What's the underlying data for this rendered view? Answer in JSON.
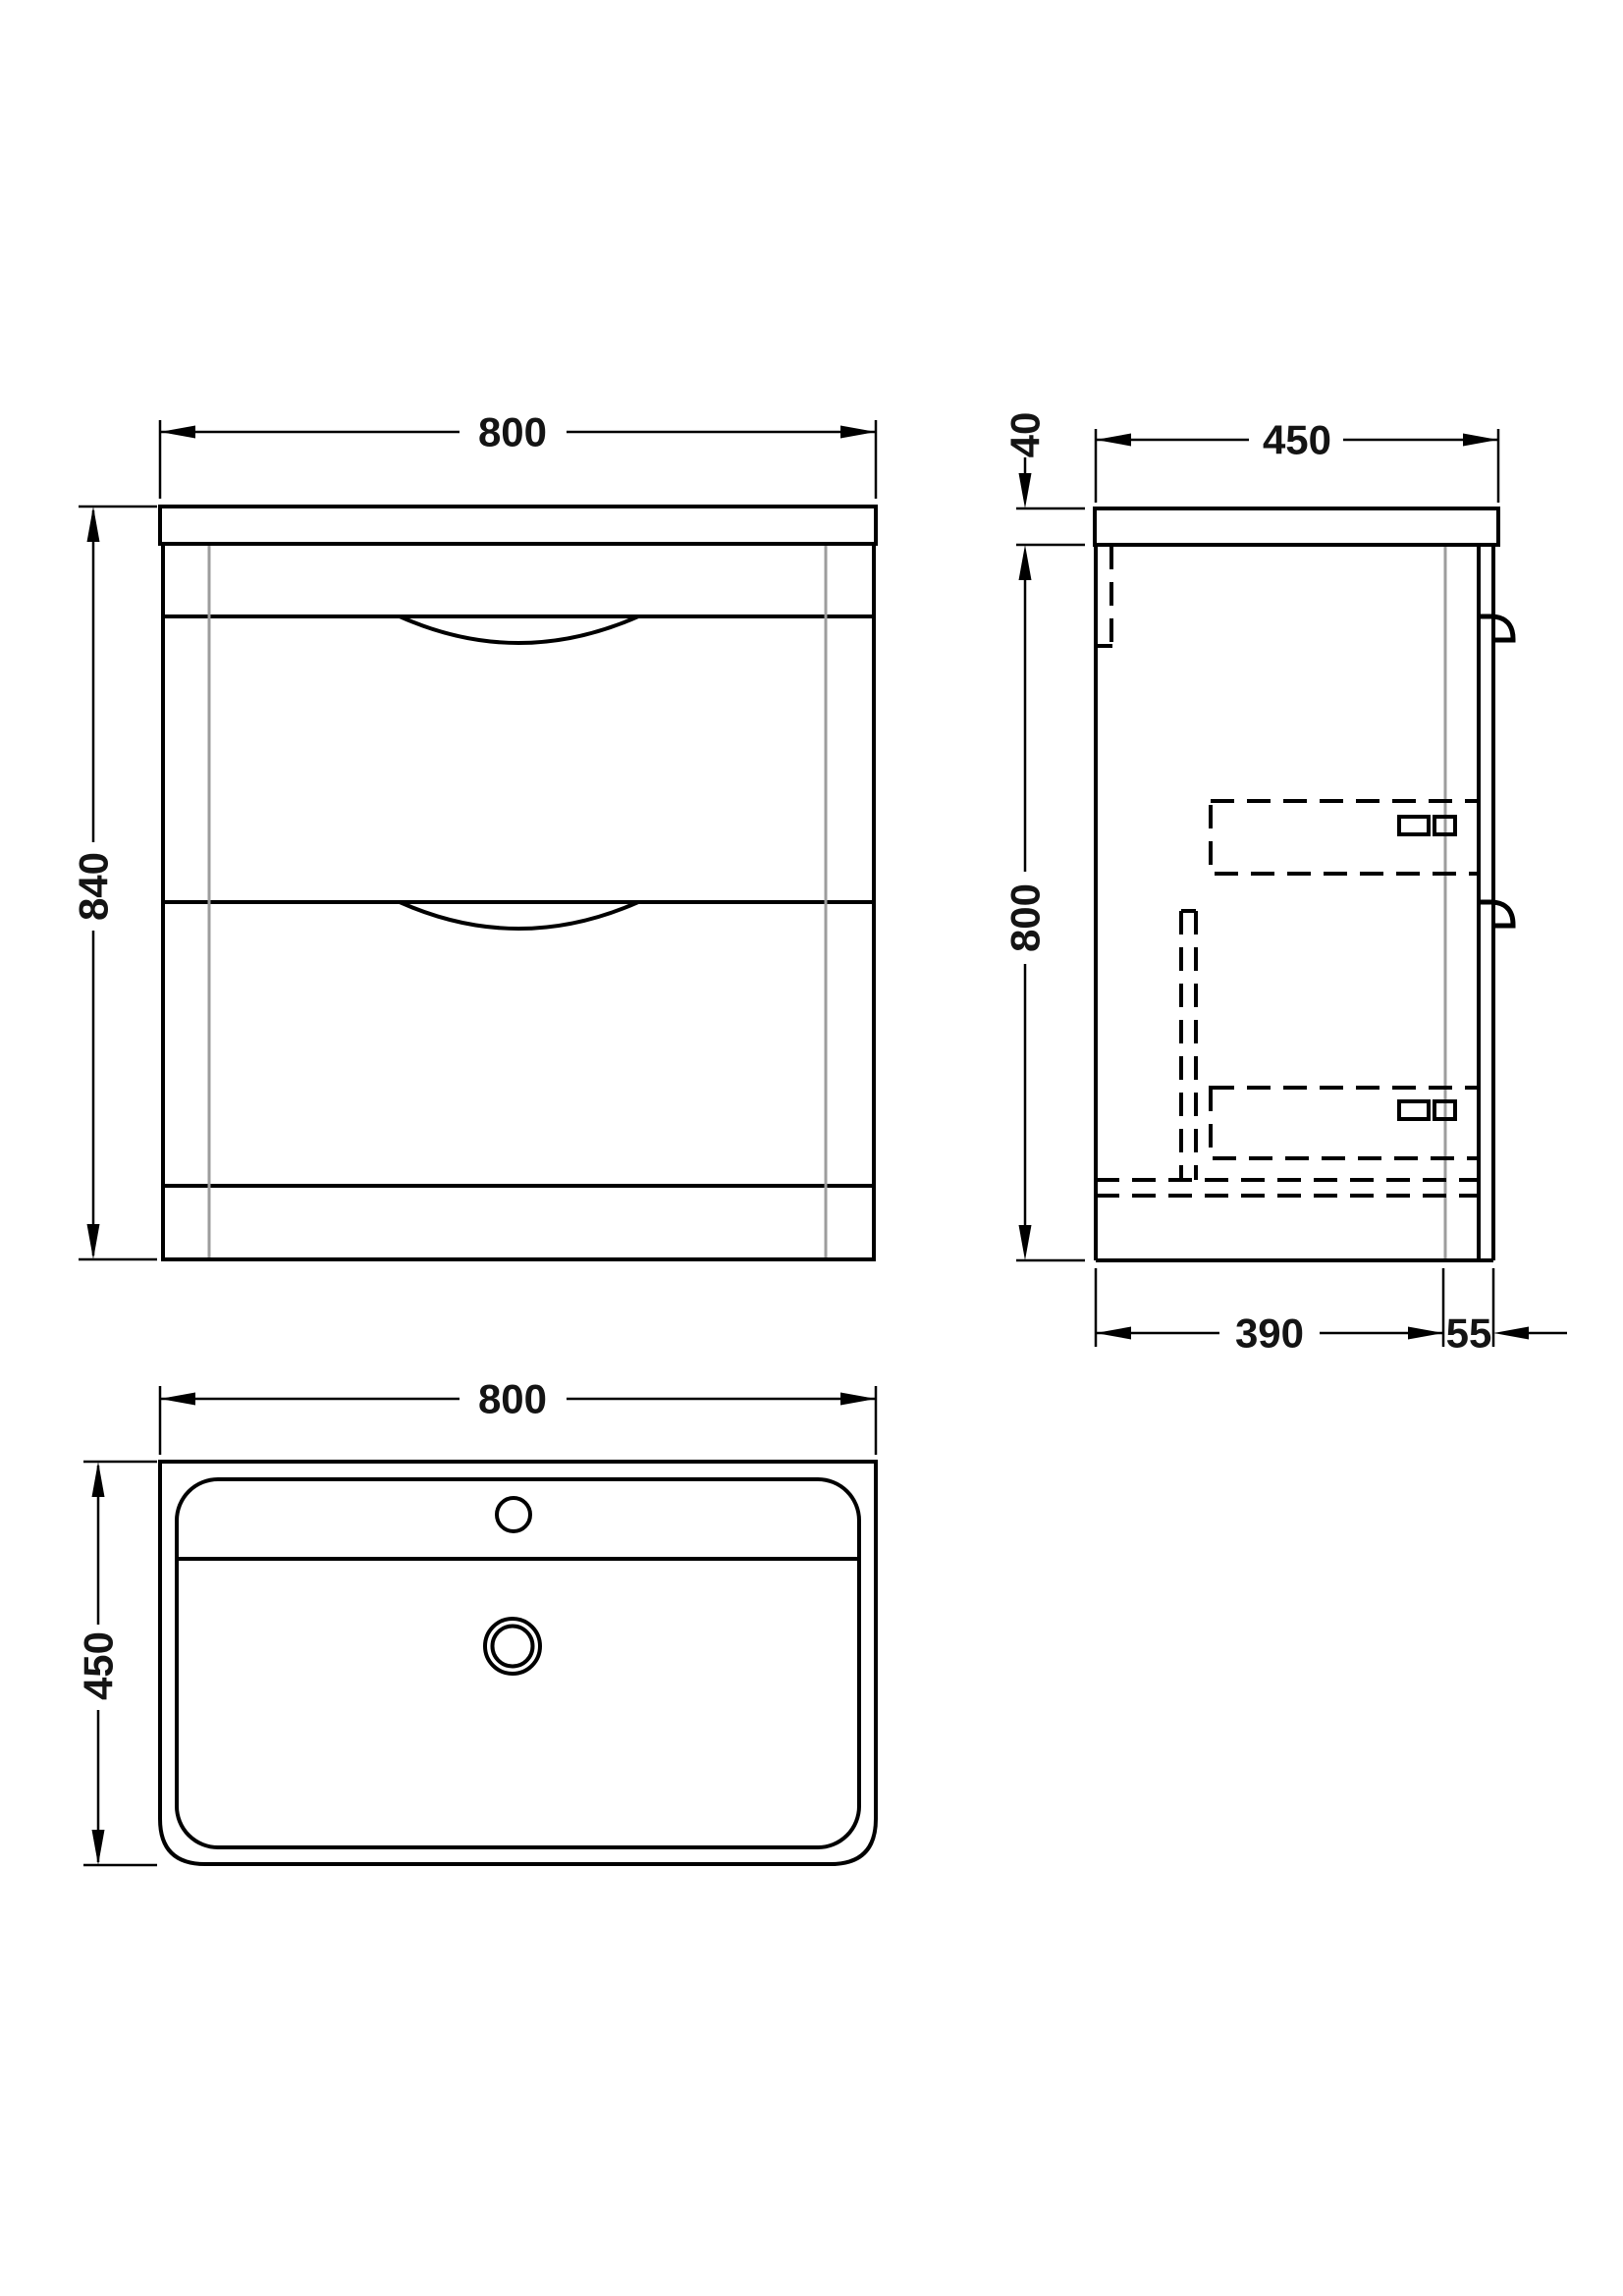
{
  "drawing": {
    "title": "vanity-unit-technical-drawing",
    "line_color": "#000000",
    "hidden_line_color": "#9d9d9d",
    "background": "#ffffff",
    "front_view": {
      "width": "800",
      "height": "840"
    },
    "side_view": {
      "worktop_thickness": "40",
      "depth": "450",
      "carcass_height": "800",
      "base_depth": "390",
      "front_offset": "55"
    },
    "plan_view": {
      "width": "800",
      "depth": "450"
    }
  }
}
